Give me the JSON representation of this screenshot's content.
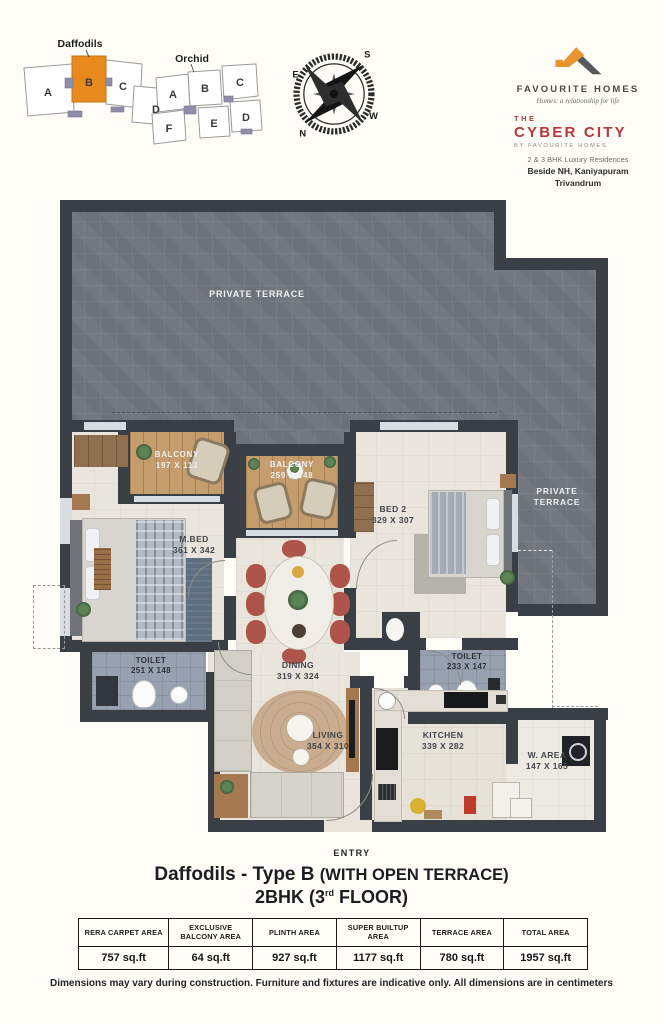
{
  "keyplan": {
    "daffodils": {
      "label": "Daffodils",
      "units": [
        "A",
        "B",
        "C",
        "D"
      ]
    },
    "orchid": {
      "label": "Orchid",
      "units": [
        "A",
        "B",
        "C",
        "F",
        "E",
        "D"
      ]
    }
  },
  "compass": {
    "n": "N",
    "e": "E",
    "s": "S",
    "w": "W"
  },
  "brand": {
    "name": "FAVOURITE HOMES",
    "tagline": "Homes: a relationship for life",
    "project": {
      "the": "THE",
      "name": "CYBER CITY",
      "by": "BY FAVOURITE HOMES",
      "desc": "2 & 3 BHK Luxury Residences",
      "address1": "Beside NH, Kaniyapuram",
      "address2": "Trivandrum"
    }
  },
  "plan": {
    "terrace_main": "PRIVATE TERRACE",
    "terrace_side": "PRIVATE TERRACE",
    "balcony1": {
      "name": "BALCONY",
      "dims": "197 X 113"
    },
    "balcony2": {
      "name": "BALCONY",
      "dims": "259 X 148"
    },
    "mbed": {
      "name": "M.BED",
      "dims": "361 X 342"
    },
    "bed2": {
      "name": "BED 2",
      "dims": "329 X 307"
    },
    "dining": {
      "name": "DINING",
      "dims": "319 X 324"
    },
    "living": {
      "name": "LIVING",
      "dims": "354 X 310"
    },
    "kitchen": {
      "name": "KITCHEN",
      "dims": "339 X 282"
    },
    "toilet1": {
      "name": "TOILET",
      "dims": "251 X 148"
    },
    "toilet2": {
      "name": "TOILET",
      "dims": "233 X 147"
    },
    "warea": {
      "name": "W. AREA",
      "dims": "147 X 165"
    },
    "entry": "ENTRY"
  },
  "title": {
    "main": "Daffodils - Type B",
    "paren": "(WITH OPEN TERRACE)",
    "line2_pre": "2BHK (3",
    "line2_sup": "rd",
    "line2_post": " FLOOR)"
  },
  "area_table": {
    "columns": [
      {
        "header": "RERA CARPET AREA",
        "value": "757 sq.ft"
      },
      {
        "header": "EXCLUSIVE BALCONY AREA",
        "value": "64 sq.ft"
      },
      {
        "header": "PLINTH AREA",
        "value": "927 sq.ft"
      },
      {
        "header": "SUPER BUILTUP AREA",
        "value": "1177 sq.ft"
      },
      {
        "header": "TERRACE AREA",
        "value": "780 sq.ft"
      },
      {
        "header": "TOTAL AREA",
        "value": "1957 sq.ft"
      }
    ]
  },
  "disclaimer": "Dimensions may vary during construction. Furniture and fixtures are indicative only. All dimensions are in centimeters",
  "colors": {
    "accent_orange": "#e8891d",
    "brand_red": "#b5383f",
    "wall": "#3a3f46"
  }
}
